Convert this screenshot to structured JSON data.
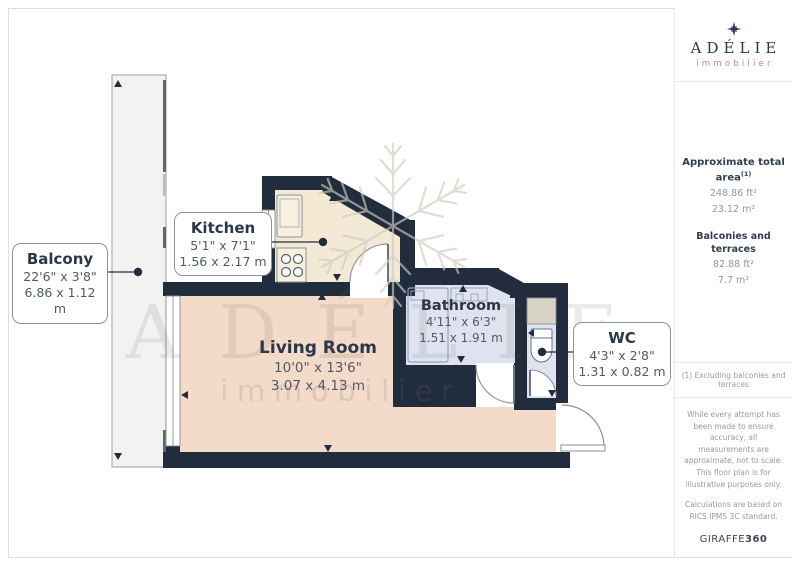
{
  "plan": {
    "rooms": {
      "balcony": {
        "name": "Balcony",
        "imperial": "22'6\" x 3'8\"",
        "metric": "6.86 x 1.12 m"
      },
      "kitchen": {
        "name": "Kitchen",
        "imperial": "5'1\" x 7'1\"",
        "metric": "1.56 x 2.17 m"
      },
      "living_room": {
        "name": "Living Room",
        "imperial": "10'0\" x 13'6\"",
        "metric": "3.07 x 4.13 m"
      },
      "bathroom": {
        "name": "Bathroom",
        "imperial": "4'11\" x 6'3\"",
        "metric": "1.51 x 1.91 m"
      },
      "wc": {
        "name": "WC",
        "imperial": "4'3\" x 2'8\"",
        "metric": "1.31 x 0.82 m"
      }
    },
    "watermark": {
      "title": "ADÉLIE",
      "subtitle": "immobilier"
    }
  },
  "sidebar": {
    "logo": {
      "name": "ADÉLIE",
      "tagline": "immobilier"
    },
    "total_area": {
      "label": "Approximate total area",
      "footnote_ref": "(1)",
      "ft": "248.86 ft²",
      "m": "23.12 m²"
    },
    "balconies": {
      "label": "Balconies and terraces",
      "ft": "82.88 ft²",
      "m": "7.7 m²"
    },
    "footnote": "(1) Excluding balconies and terraces",
    "disclaimer": "While every attempt has been made to ensure accuracy, all measurements are approximate, not to scale. This floor plan is for illustrative purposes only.",
    "standard": "Calculations are based on RICS IPMS 3C standard.",
    "brand": {
      "name": "GIRAFFE",
      "number": "360"
    }
  },
  "colors": {
    "wall": "#212c3d",
    "living": "#f4dac9",
    "kitchen": "#f3e9d4",
    "bath": "#dfe3ef",
    "balcony": "#f2f2f1",
    "accent": "#c6897a"
  }
}
